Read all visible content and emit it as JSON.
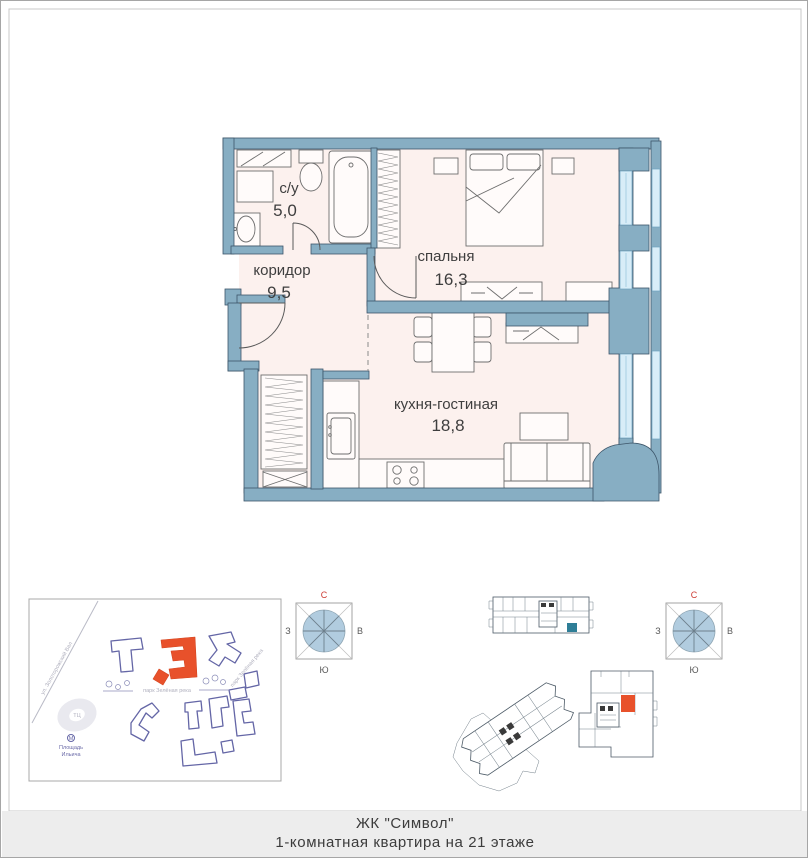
{
  "footer": {
    "line1": "ЖК \"Символ\"",
    "line2": "1-комнатная квартира на 21 этаже"
  },
  "rooms": {
    "bathroom": {
      "name": "с/у",
      "area": "5,0"
    },
    "corridor": {
      "name": "коридор",
      "area": "9,5"
    },
    "bedroom": {
      "name": "спальня",
      "area": "16,3"
    },
    "kitchen": {
      "name": "кухня-гостиная",
      "area": "18,8"
    }
  },
  "compass": {
    "north": "С",
    "south": "Ю",
    "west": "З",
    "east": "В"
  },
  "map": {
    "street_label": "ул. Золоторожский Вал",
    "park_label": "парк Зелёная река",
    "metro_label_line1": "Площадь",
    "metro_label_line2": "Ильича",
    "mall_label": "ТЦ"
  },
  "colors": {
    "wall_blue": "#87aec3",
    "room_fill": "#fcf1ee",
    "window_blue": "#d8edf8",
    "highlight_orange": "#e8512b",
    "unit_teal": "#2e7e97",
    "compass_north_red": "#cc3b33",
    "map_purple": "#6466a6"
  }
}
